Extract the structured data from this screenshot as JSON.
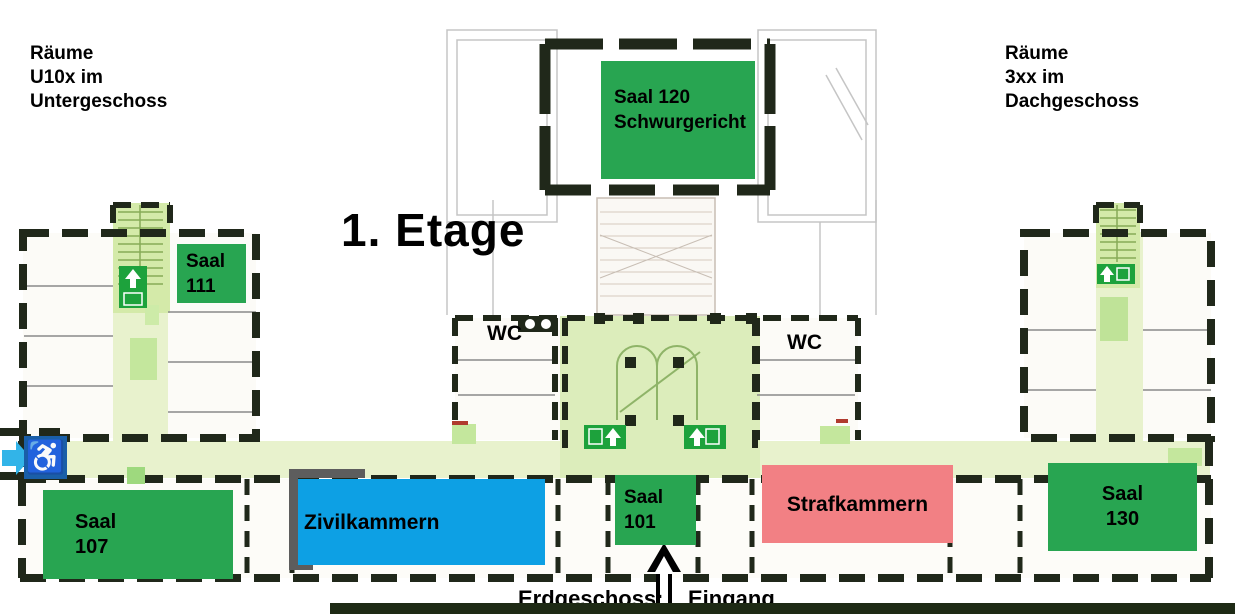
{
  "title": "1. Etage",
  "legend_top_left": {
    "line1": "Räume",
    "line2": "U10x im",
    "line3": "Untergeschoss"
  },
  "legend_top_right": {
    "line1": "Räume",
    "line2": "3xx im",
    "line3": "Dachgeschoss"
  },
  "wc_left": "WC",
  "wc_right": "WC",
  "bottom": {
    "prefix": "Erdgeschoss:",
    "suffix": "Eingang"
  },
  "rooms": {
    "saal120": {
      "line1": "Saal 120",
      "line2": "Schwurgericht",
      "color": "#28a551"
    },
    "saal111": {
      "line1": "Saal",
      "line2": "111",
      "color": "#28a551"
    },
    "saal107": {
      "line1": "Saal",
      "line2": "107",
      "color": "#28a551"
    },
    "saal101": {
      "line1": "Saal",
      "line2": "101",
      "color": "#28a551"
    },
    "saal130": {
      "line1": "Saal",
      "line2": "130",
      "color": "#28a551"
    },
    "zivilkammern": {
      "line1": "Zivilkammern",
      "color": "#0da0e4"
    },
    "strafkammern": {
      "line1": "Strafkammern",
      "color": "#f28084"
    }
  },
  "icons": {
    "wheelchair_icon": "♿",
    "accessible_route_arrow_icon": "→",
    "entrance_arrow_icon": "⬆",
    "exit_sign_icon": "↑"
  },
  "colors": {
    "room_green": "#28a551",
    "zivil_blue": "#0da0e4",
    "straf_pink": "#f28084",
    "accessible_sign_blue": "#1a5fa8",
    "accessible_arrow_cyan": "#32b4e8",
    "corridor_green": "#e8f2cd",
    "lobby_green": "#dcedbb",
    "exit_sign_green": "#1da23c",
    "wall_dark": "#20281a"
  }
}
